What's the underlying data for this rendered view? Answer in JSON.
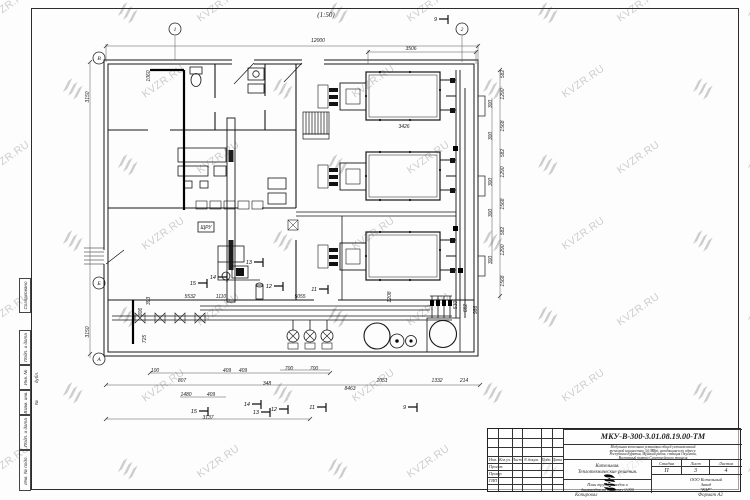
{
  "sheet": {
    "scale_label": "(1:50)",
    "copy_label": "Копировал",
    "format_label": "Формат А2"
  },
  "watermark": {
    "text": "KVZR.RU",
    "color": "#c0c2c4"
  },
  "side_stamps": [
    {
      "label": "Согласовано"
    },
    {
      "label": "Подп. и дата"
    },
    {
      "label": "Инв. № дубл."
    },
    {
      "label": "Взам. инв. №"
    },
    {
      "label": "Подп. и дата"
    },
    {
      "label": "Инв. № подл."
    }
  ],
  "title_block": {
    "doc_number": "МКУ-В-300-3.01.08.19.00-ТМ",
    "description_lines": [
      "Модульная котельная установка общей установленной",
      "тепловой мощностью 3,0 МВт, находящаяся по адресу:",
      "Республика Бурятия, Муйский район, станция Окусикан,",
      "Восточный портал Северомуйского тоннеля"
    ],
    "object_line1": "Котельная.",
    "object_line2": "Теплотехнические решения.",
    "sheet_title_line1": "План трубопроводов и",
    "sheet_title_line2": "дымоходов на отметку 0,000",
    "stage_header": "Стадия",
    "sheet_header": "Лист",
    "sheets_header": "Листов",
    "stage": "П",
    "sheet": "3",
    "sheets": "4",
    "company_line1": "ООО Котельный",
    "company_line2": "Завод",
    "company_line3": "\"КЗР\"",
    "columns": [
      "Изм.",
      "Кол.уч.",
      "Лист",
      "N докум.",
      "Подп.",
      "Дата"
    ],
    "rows": [
      "Проект.",
      "Провер.",
      "ГИП"
    ]
  },
  "plan": {
    "dimensions": [
      [
        "12000",
        318,
        42,
        0
      ],
      [
        "3506",
        411,
        50,
        0
      ],
      [
        "3426",
        404,
        128,
        0
      ],
      [
        "1060",
        150,
        76,
        -90
      ],
      [
        "3150",
        89,
        97,
        -90
      ],
      [
        "3150",
        89,
        332,
        -90
      ],
      [
        "393",
        150,
        301,
        -90
      ],
      [
        "306",
        142,
        312,
        -90
      ],
      [
        "725",
        146,
        339,
        -90
      ],
      [
        "5532",
        190,
        298,
        0
      ],
      [
        "1110",
        221,
        298,
        0
      ],
      [
        "5055",
        300,
        298,
        0
      ],
      [
        "1208",
        391,
        297,
        -90
      ],
      [
        "582",
        504,
        74,
        -90
      ],
      [
        "1290",
        504,
        94,
        -90
      ],
      [
        "300",
        492,
        104,
        -90
      ],
      [
        "1568",
        504,
        126,
        -90
      ],
      [
        "300",
        492,
        136,
        -90
      ],
      [
        "582",
        504,
        153,
        -90
      ],
      [
        "1290",
        504,
        172,
        -90
      ],
      [
        "300",
        492,
        182,
        -90
      ],
      [
        "1568",
        504,
        204,
        -90
      ],
      [
        "300",
        492,
        213,
        -90
      ],
      [
        "582",
        504,
        231,
        -90
      ],
      [
        "1290",
        504,
        250,
        -90
      ],
      [
        "300",
        492,
        260,
        -90
      ],
      [
        "1568",
        504,
        281,
        -90
      ],
      [
        "530",
        457,
        305,
        -90
      ],
      [
        "682",
        467,
        308,
        -90
      ],
      [
        "986",
        477,
        310,
        -90
      ],
      [
        "100",
        155,
        372,
        0
      ],
      [
        "807",
        182,
        382,
        0
      ],
      [
        "1480",
        186,
        396,
        0
      ],
      [
        "409",
        211,
        396,
        0
      ],
      [
        "409",
        227,
        372,
        0
      ],
      [
        "409",
        243,
        372,
        0
      ],
      [
        "3137",
        208,
        419,
        0
      ],
      [
        "348",
        267,
        385,
        0
      ],
      [
        "700",
        289,
        370,
        0
      ],
      [
        "700",
        314,
        370,
        0
      ],
      [
        "8463",
        350,
        390,
        0
      ],
      [
        "2051",
        382,
        382,
        0
      ],
      [
        "1332",
        437,
        382,
        0
      ],
      [
        "214",
        464,
        382,
        0
      ],
      [
        "ЩРУ",
        206,
        229,
        0
      ]
    ],
    "axes": [
      [
        "В",
        99,
        58
      ],
      [
        "Б",
        99,
        283
      ],
      [
        "А",
        99,
        359
      ],
      [
        "1",
        175,
        29
      ],
      [
        "2",
        462,
        29
      ]
    ],
    "flags": [
      [
        "9",
        437,
        19
      ],
      [
        "13",
        252,
        262
      ],
      [
        "14",
        216,
        277
      ],
      [
        "15",
        196,
        283
      ],
      [
        "12",
        272,
        286
      ],
      [
        "11",
        317,
        289
      ],
      [
        "15",
        197,
        411
      ],
      [
        "14",
        250,
        404
      ],
      [
        "13",
        259,
        412
      ],
      [
        "12",
        277,
        409
      ],
      [
        "11",
        315,
        407
      ],
      [
        "9",
        406,
        407
      ]
    ]
  }
}
